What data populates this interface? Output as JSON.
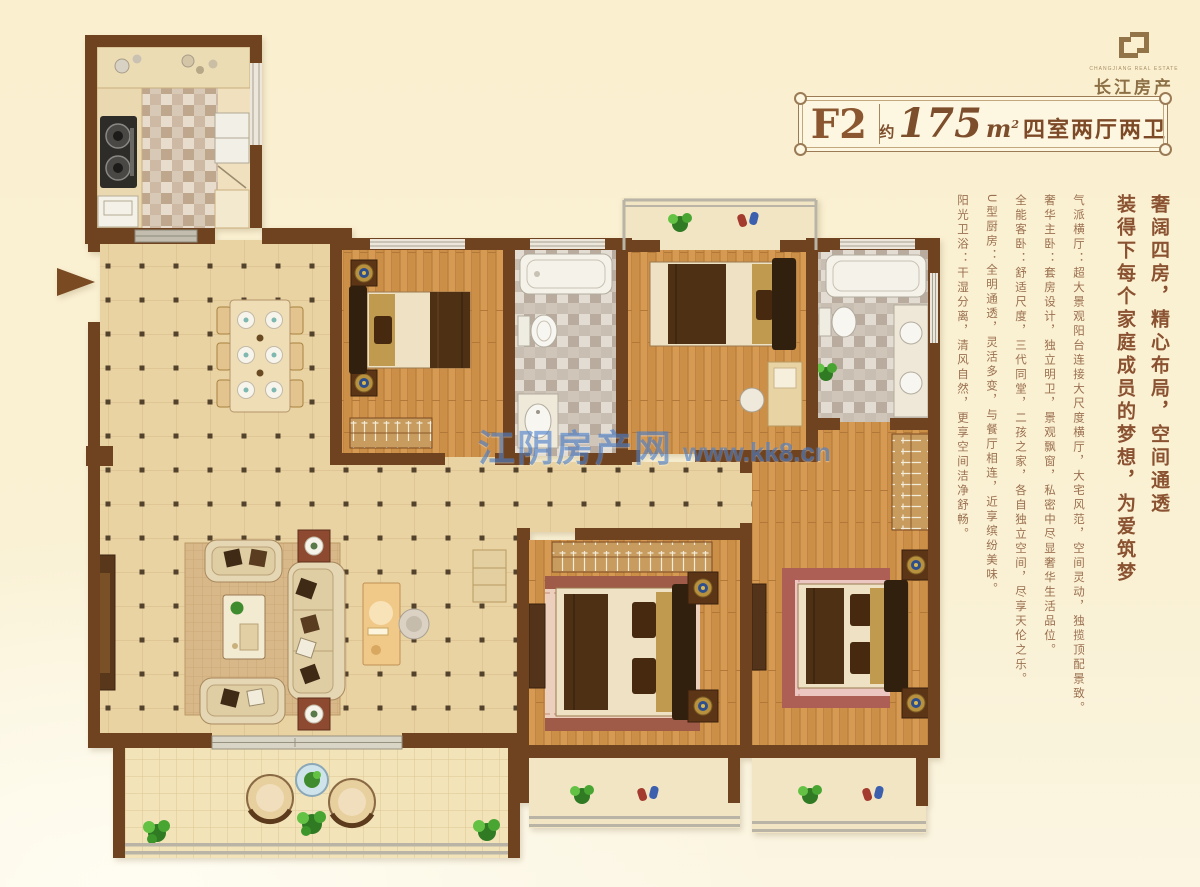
{
  "logo": {
    "name": "长江房产",
    "tagline": "CHANGJIANG REAL ESTATE"
  },
  "badge": {
    "unit_code": "F2",
    "area_prefix": "约",
    "area_value": "175",
    "area_unit": "m",
    "area_unit_exp": "2",
    "layout_text": "四室两厅两卫"
  },
  "description": {
    "headline1": "奢阔四房，精心布局，空间通透",
    "headline2": "装得下每个家庭成员的梦想，为爱筑梦",
    "features": [
      "气派横厅：超大景观阳台连接大尺度横厅，大宅风范，空间灵动，独揽顶配景致。",
      "奢华主卧：套房设计，独立明卫，景观飘窗，私密中尽显奢华生活品位。",
      "全能客卧：舒适尺度，三代同堂，二孩之家，各自独立空间，尽享天伦之乐。",
      "U型厨房：全明通透，灵活多变，与餐厅相连，近享缤纷美味。",
      "阳光卫浴：干湿分离，清风自然，更享空间洁净舒畅。"
    ]
  },
  "watermark": {
    "site_name": "江阴房产网",
    "site_url": "www.kk8.cn"
  },
  "colors": {
    "page_bg": "#faf1d4",
    "wall_brown": "#6f4320",
    "wood_floor": "#d69a53",
    "tile_floor": "#e9d3a3",
    "accent_text": "#8a5a38",
    "badge_text": "#7d4e2c",
    "watermark_blue": "#4b80cc",
    "logo_brown": "#937449"
  },
  "floorplan": {
    "entry_arrow_direction": "right",
    "rooms": [
      "kitchen",
      "dining-area",
      "living-room",
      "bedroom-top-middle",
      "guest-bathroom",
      "bedroom-top-right",
      "master-bathroom",
      "hallway",
      "bedroom-bottom-middle",
      "master-bedroom",
      "walk-in-closet",
      "balcony",
      "bay-windows"
    ]
  }
}
